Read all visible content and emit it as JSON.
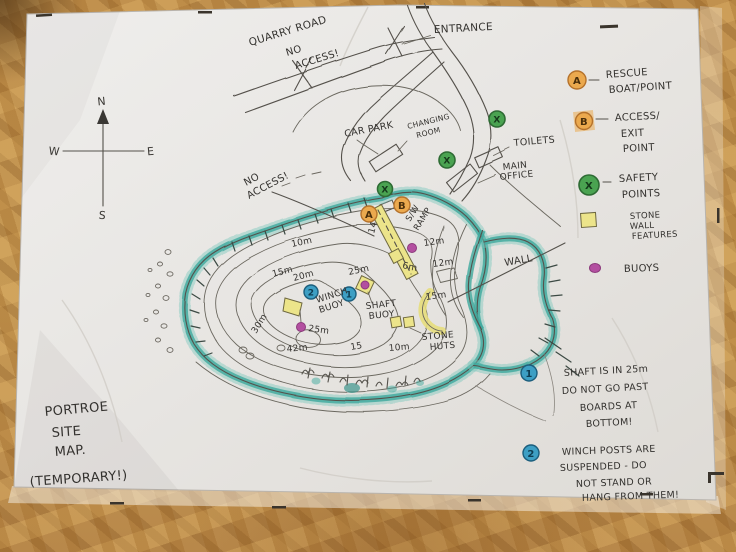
{
  "title": {
    "l1": "PORTROE",
    "l2": "SITE",
    "l3": "MAP.",
    "l4": "(TEMPORARY!)"
  },
  "compass": {
    "n": "N",
    "e": "E",
    "s": "S",
    "w": "W"
  },
  "roads": {
    "quarry": "QUARRY ROAD",
    "no": "NO",
    "access": "ACCESS!",
    "entrance": "ENTRANCE"
  },
  "site": {
    "car_park": "CAR PARK",
    "changing1": "CHANGING",
    "changing2": "ROOM",
    "toilets": "TOILETS",
    "office1": "MAIN",
    "office2": "OFFICE",
    "no_access1": "NO",
    "no_access2": "ACCESS!"
  },
  "lake": {
    "ramp1": "S/W",
    "ramp2": "RAMP",
    "ramp_depth": "14",
    "winch1": "WINCH",
    "winch2": "BUOY",
    "shaft1": "SHAFT",
    "shaft2": "BUOY",
    "huts1": "STONE",
    "huts2": "HUTS",
    "wall": "WALL",
    "d10": "10m",
    "d15": "15m",
    "d20": "20m",
    "d25a": "25m",
    "d30": "30m",
    "d42": "42m",
    "d25b": "25m",
    "d12a": "12m",
    "d12b": "12m",
    "d6": "6m",
    "d15e": "15m",
    "d15s": "15",
    "d10s": "10m"
  },
  "markers": {
    "a": "A",
    "b": "B",
    "x": "X",
    "n1": "1",
    "n2": "2"
  },
  "legend": {
    "a": "A",
    "a1": "RESCUE",
    "a2": "BOAT/POINT",
    "b": "B",
    "b1": "ACCESS/",
    "b2": "EXIT",
    "b3": "POINT",
    "x": "X",
    "x1": "SAFETY",
    "x2": "POINTS",
    "w1": "STONE",
    "w2": "WALL",
    "w3": "FEATURES",
    "buoys": "BUOYS"
  },
  "notes": {
    "n1": "1",
    "n1l1": "SHAFT IS IN 25m",
    "n1l2": "DO NOT GO PAST",
    "n1l3": "BOARDS AT",
    "n1l4": "BOTTOM!",
    "n2": "2",
    "n2l1": "WINCH POSTS ARE",
    "n2l2": "SUSPENDED - DO",
    "n2l3": "NOT STAND OR",
    "n2l4": "HANG FROM THEM!"
  },
  "colors": {
    "shore_teal": "#3fa99e",
    "feature_yellow": "#ece48a",
    "marker_orange": "#eba94e",
    "safety_green": "#4aa351",
    "buoy_magenta": "#b34fa0",
    "note_blue": "#3d9fc4",
    "ink": "#33312e",
    "paper": "#e9e7e4",
    "wood": "#c79a55"
  }
}
